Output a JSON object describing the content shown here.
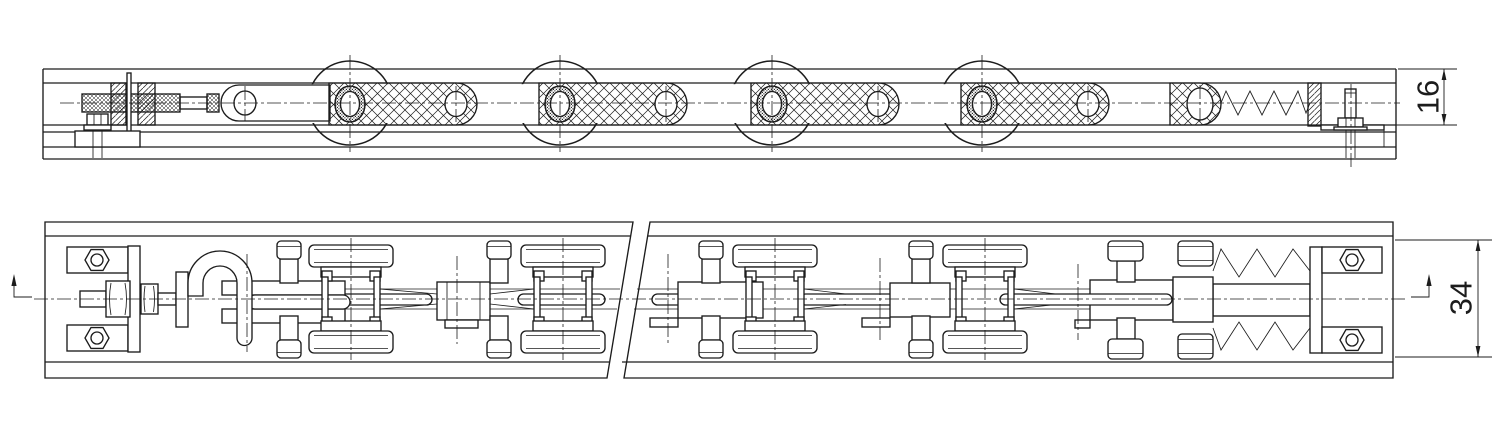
{
  "drawing": {
    "background": "#ffffff",
    "line_color": "#1c1c1c",
    "dimensions": [
      {
        "id": "dim-height",
        "label": "16",
        "orientation": "vertical"
      },
      {
        "id": "dim-width",
        "label": "34",
        "orientation": "vertical"
      }
    ],
    "icons": {
      "section_direction_arrow": "↑"
    }
  }
}
